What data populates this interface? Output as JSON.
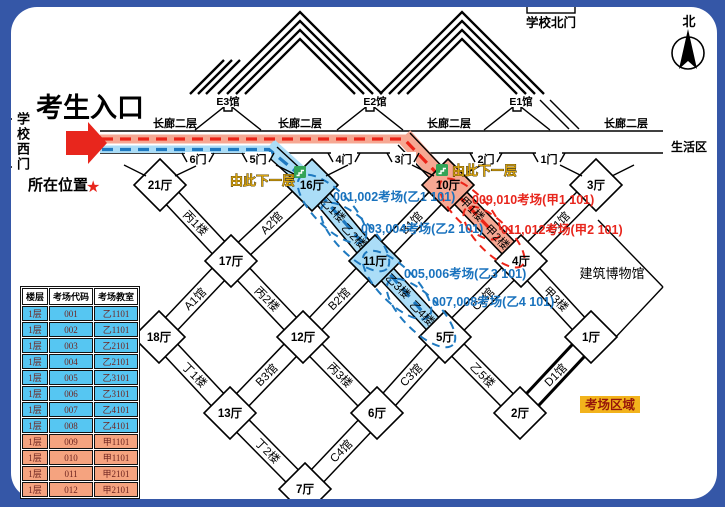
{
  "header": {
    "entrance": "考生入口",
    "west_gate": "学校西门",
    "north_gate": "学校北门",
    "north": "北",
    "current_location": "所在位置",
    "star": "★",
    "floor_title": "一层"
  },
  "corridor": {
    "labels": [
      "长廊二层",
      "长廊二层",
      "长廊二层",
      "长廊二层"
    ],
    "living_area": "生活区"
  },
  "gates": [
    "6门",
    "5门",
    "4门",
    "3门",
    "2门",
    "1门"
  ],
  "e_halls": [
    "E3馆",
    "E2馆",
    "E1馆"
  ],
  "halls": [
    "21厅",
    "16厅",
    "10厅",
    "3厅",
    "17厅",
    "11厅",
    "4厅",
    "18厅",
    "12厅",
    "5厅",
    "1厅",
    "13厅",
    "6厅",
    "2厅",
    "7厅"
  ],
  "buildings": [
    "丙1楼",
    "A2馆",
    "B1馆",
    "C1馆",
    "A1馆",
    "丙2楼",
    "B2馆",
    "C2馆",
    "甲3楼",
    "丁1楼",
    "B3馆",
    "丙3楼",
    "C3馆",
    "乙5楼",
    "D1馆",
    "丁2楼",
    "C4馆"
  ],
  "highlight_buildings": {
    "blue": [
      "乙1楼",
      "乙2楼",
      "乙3楼",
      "乙4楼"
    ],
    "red": [
      "甲1楼",
      "甲2楼"
    ]
  },
  "notes": {
    "go_down_left": "由此下一层",
    "go_down_right": "由此下一层",
    "exam_area": "考场区域",
    "museum": "建筑博物馆"
  },
  "assignments": {
    "blue": [
      "001,002考场(乙1 101)",
      "003,004考场(乙2 101)",
      "005,006考场(乙3 101)",
      "007,008考场(乙4 101)"
    ],
    "red": [
      "009,010考场(甲1 101)",
      "011,012考场(甲2 101)"
    ]
  },
  "legend_table": {
    "headers": [
      "楼层",
      "考场代码",
      "考场教室"
    ],
    "rows": [
      [
        "1层",
        "001",
        "乙1101"
      ],
      [
        "1层",
        "002",
        "乙1101"
      ],
      [
        "1层",
        "003",
        "乙2101"
      ],
      [
        "1层",
        "004",
        "乙2101"
      ],
      [
        "1层",
        "005",
        "乙3101"
      ],
      [
        "1层",
        "006",
        "乙3101"
      ],
      [
        "1层",
        "007",
        "乙4101"
      ],
      [
        "1层",
        "008",
        "乙4101"
      ],
      [
        "1层",
        "009",
        "甲1101"
      ],
      [
        "1层",
        "010",
        "甲1101"
      ],
      [
        "1层",
        "011",
        "甲2101"
      ],
      [
        "1层",
        "012",
        "甲2101"
      ]
    ]
  },
  "colors": {
    "frame": "#3557A7",
    "route_red": "#EC2418",
    "route_red_band": "#F6A893",
    "route_blue": "#1E79C0",
    "route_blue_band": "#ABDDF7",
    "table_blue": "#56C6F2",
    "table_red": "#F5A37F",
    "gold_text": "#D9A40F",
    "stairs_green": "#33A457",
    "exam_area_bg": "#F2B31C"
  }
}
